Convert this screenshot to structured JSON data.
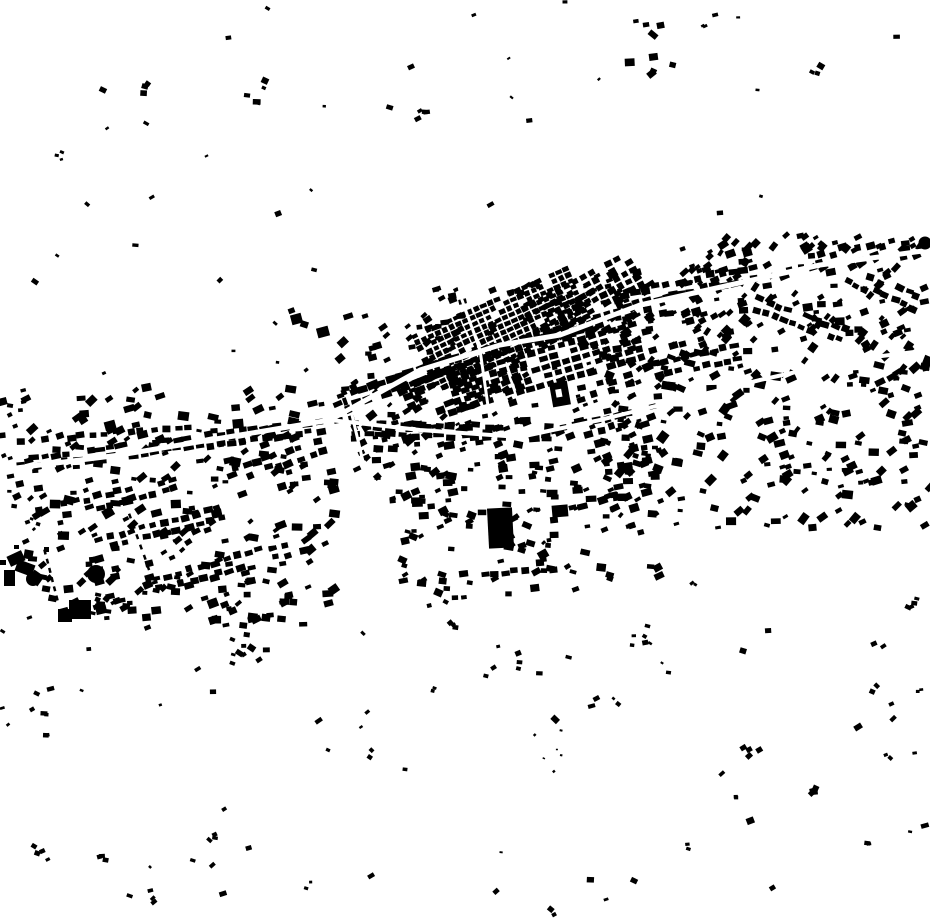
{
  "map": {
    "width": 930,
    "height": 924,
    "colors": {
      "ink": "#000000",
      "bg": "#ffffff"
    },
    "seed": 1337,
    "legend": {
      "scatter": "[x,y,w,h,count,sizeMin,sizeMax,angle,angleJitter]",
      "rows": "[x1,y1,x2,y2,[perpOffsets],spacing,bw,bh,posJitter,angJitter,skipProb]",
      "grids": "[cx,cy,w,h,angle,cellW,cellH,gapX,gapY,skipProb]",
      "clusters": "[cx,cy,radius,count,sizeMin,sizeMax]",
      "roads": "[strokeWidth,[x,y,x,y,...]]",
      "landmark_rects": "[x,y,w,h,angle]",
      "landmark_circles": "[cx,cy,r]",
      "landmark_holed": "[x,y,w,h,angle,holeX,holeY,holeW,holeH]",
      "landmark_dashes": "[x1,y1,x2,y2,count,dashW,dashL]"
    },
    "scatter": [
      [
        25,
        385,
        310,
        235,
        230,
        5,
        11,
        -15,
        30
      ],
      [
        335,
        315,
        130,
        165,
        75,
        5,
        10,
        -20,
        25
      ],
      [
        360,
        420,
        300,
        90,
        130,
        5,
        11,
        -8,
        20
      ],
      [
        400,
        510,
        260,
        90,
        70,
        5,
        10,
        -5,
        30
      ],
      [
        600,
        350,
        330,
        180,
        230,
        5,
        11,
        -15,
        40
      ],
      [
        680,
        235,
        250,
        115,
        150,
        5,
        10,
        -30,
        30
      ],
      [
        560,
        270,
        140,
        80,
        70,
        5,
        10,
        -25,
        20
      ],
      [
        430,
        280,
        210,
        150,
        110,
        4,
        9,
        -20,
        15
      ],
      [
        90,
        560,
        220,
        70,
        45,
        5,
        10,
        -12,
        20
      ],
      [
        0,
        0,
        930,
        225,
        26,
        3,
        7,
        0,
        45
      ],
      [
        0,
        630,
        930,
        290,
        52,
        3,
        8,
        0,
        45
      ],
      [
        0,
        235,
        330,
        140,
        10,
        3,
        7,
        0,
        45
      ],
      [
        0,
        390,
        30,
        140,
        18,
        4,
        9,
        -10,
        20
      ]
    ],
    "rows": [
      [
        30,
        462,
        330,
        425,
        [
          -4,
          5
        ],
        11,
        9,
        6,
        2,
        6,
        0.1
      ],
      [
        40,
        440,
        200,
        425,
        [
          0
        ],
        12,
        8,
        6,
        2,
        6,
        0.15
      ],
      [
        350,
        430,
        560,
        432,
        [
          -5,
          5
        ],
        12,
        9,
        6,
        2,
        6,
        0.2
      ],
      [
        350,
        398,
        460,
        360,
        [
          -5,
          6
        ],
        10,
        10,
        7,
        1.5,
        5,
        0.08
      ],
      [
        620,
        300,
        770,
        268,
        [
          -5,
          6
        ],
        11,
        9,
        6,
        2,
        6,
        0.12
      ],
      [
        770,
        268,
        920,
        243,
        [
          -4,
          6
        ],
        12,
        8,
        6,
        2,
        8,
        0.3
      ],
      [
        60,
        505,
        180,
        478,
        [
          0,
          10
        ],
        11,
        8,
        6,
        2,
        7,
        0.15
      ],
      [
        95,
        540,
        230,
        505,
        [
          0,
          11
        ],
        11,
        8,
        6,
        2,
        7,
        0.15
      ],
      [
        150,
        580,
        300,
        540,
        [
          0,
          11
        ],
        12,
        8,
        6,
        2,
        7,
        0.2
      ],
      [
        230,
        470,
        330,
        440,
        [
          0,
          10
        ],
        11,
        8,
        6,
        2,
        7,
        0.15
      ],
      [
        648,
        352,
        745,
        330,
        [
          0,
          13,
          26
        ],
        10,
        8,
        6,
        1.5,
        5,
        0.15
      ],
      [
        560,
        430,
        660,
        405,
        [
          0,
          10
        ],
        11,
        8,
        6,
        2,
        7,
        0.2
      ],
      [
        460,
        575,
        560,
        568,
        [
          0
        ],
        10,
        8,
        6,
        2,
        6,
        0.2
      ],
      [
        575,
        390,
        640,
        372,
        [
          0,
          10
        ],
        10,
        8,
        6,
        2,
        6,
        0.2
      ],
      [
        755,
        297,
        850,
        332,
        [
          0,
          11
        ],
        10,
        8,
        6,
        2,
        7,
        0.2
      ],
      [
        848,
        268,
        925,
        300,
        [
          0,
          12
        ],
        10,
        8,
        6,
        2,
        7,
        0.25
      ],
      [
        338,
        380,
        358,
        435,
        [
          0
        ],
        9,
        7,
        5,
        1.5,
        6,
        0.1
      ]
    ],
    "grids": [
      [
        505,
        330,
        170,
        62,
        -24,
        6,
        5,
        1.5,
        1.5,
        0.12
      ],
      [
        545,
        362,
        190,
        58,
        -16,
        8,
        6,
        2.5,
        2.5,
        0.22
      ],
      [
        470,
        390,
        120,
        50,
        -20,
        9,
        7,
        3,
        3,
        0.3
      ],
      [
        588,
        300,
        120,
        45,
        -28,
        7,
        6,
        2.5,
        2.5,
        0.25
      ]
    ],
    "clusters": [
      [
        648,
        52,
        42,
        9,
        5,
        10
      ],
      [
        425,
        112,
        16,
        4,
        4,
        8
      ],
      [
        258,
        100,
        26,
        5,
        4,
        8
      ],
      [
        146,
        87,
        12,
        3,
        4,
        7
      ],
      [
        66,
        152,
        14,
        3,
        3,
        6
      ],
      [
        812,
        72,
        10,
        3,
        4,
        7
      ],
      [
        703,
        26,
        6,
        2,
        3,
        5
      ],
      [
        294,
        322,
        22,
        2,
        6,
        8
      ],
      [
        240,
        648,
        26,
        8,
        4,
        8
      ],
      [
        448,
        616,
        20,
        5,
        4,
        7
      ],
      [
        500,
        660,
        26,
        5,
        3,
        6
      ],
      [
        640,
        640,
        22,
        6,
        4,
        7
      ],
      [
        752,
        752,
        12,
        4,
        4,
        7
      ],
      [
        815,
        790,
        14,
        4,
        4,
        7
      ],
      [
        911,
        607,
        12,
        4,
        4,
        7
      ],
      [
        877,
        650,
        8,
        2,
        4,
        6
      ],
      [
        880,
        690,
        8,
        2,
        4,
        6
      ],
      [
        40,
        708,
        10,
        3,
        4,
        7
      ],
      [
        50,
        735,
        8,
        2,
        4,
        6
      ],
      [
        208,
        835,
        8,
        3,
        4,
        6
      ],
      [
        100,
        858,
        8,
        2,
        4,
        6
      ],
      [
        44,
        858,
        10,
        3,
        4,
        7
      ],
      [
        150,
        895,
        12,
        3,
        4,
        6
      ],
      [
        305,
        885,
        8,
        2,
        3,
        5
      ],
      [
        550,
        908,
        8,
        2,
        4,
        6
      ],
      [
        868,
        848,
        8,
        2,
        4,
        6
      ],
      [
        686,
        845,
        8,
        2,
        3,
        5
      ],
      [
        740,
        798,
        6,
        2,
        3,
        5
      ],
      [
        890,
        758,
        6,
        2,
        3,
        5
      ],
      [
        922,
        690,
        6,
        2,
        3,
        5
      ],
      [
        35,
        523,
        10,
        4,
        3,
        5
      ],
      [
        110,
        600,
        18,
        5,
        4,
        7
      ],
      [
        368,
        755,
        6,
        2,
        3,
        5
      ],
      [
        430,
        690,
        6,
        2,
        3,
        5
      ],
      [
        615,
        700,
        6,
        2,
        3,
        5
      ],
      [
        692,
        583,
        6,
        2,
        3,
        5
      ],
      [
        544,
        545,
        8,
        3,
        4,
        6
      ],
      [
        560,
        750,
        40,
        6,
        2,
        3
      ]
    ],
    "roads": [
      [
        5,
        [
          0,
          470,
          120,
          455,
          240,
          435,
          330,
          420,
          420,
          370,
          500,
          345,
          560,
          335,
          640,
          305,
          730,
          285,
          820,
          265,
          930,
          250
        ]
      ],
      [
        4,
        [
          330,
          420,
          420,
          430,
          520,
          437,
          600,
          420,
          680,
          400,
          760,
          380,
          850,
          360,
          930,
          350
        ]
      ],
      [
        3,
        [
          490,
          420,
          480,
          350,
          462,
          300,
          452,
          255
        ]
      ],
      [
        3,
        [
          352,
          415,
          365,
          470,
          385,
          540,
          402,
          600
        ]
      ]
    ],
    "landmarks": {
      "rects": [
        [
          58,
          609,
          14,
          13,
          0
        ],
        [
          69,
          600,
          22,
          19,
          0
        ],
        [
          291,
          314,
          11,
          10,
          -15
        ],
        [
          317,
          327,
          12,
          10,
          -15
        ],
        [
          488,
          508,
          25,
          40,
          -3
        ],
        [
          552,
          505,
          16,
          12,
          -5
        ],
        [
          8,
          553,
          16,
          11,
          -25
        ],
        [
          16,
          562,
          18,
          12,
          20
        ],
        [
          4,
          570,
          11,
          16,
          0
        ],
        [
          24,
          550,
          9,
          9,
          10
        ],
        [
          30,
          572,
          12,
          12,
          35
        ],
        [
          44,
          547,
          5,
          5,
          0
        ],
        [
          14,
          545,
          5,
          4,
          0
        ],
        [
          0,
          560,
          6,
          5,
          0
        ]
      ],
      "circles": [
        [
          925,
          243,
          6.5
        ],
        [
          33,
          579,
          7
        ],
        [
          96,
          574,
          9
        ]
      ],
      "holed": [
        [
          551,
          382,
          18,
          24,
          -10,
          556,
          389,
          6,
          8
        ]
      ],
      "dashes": [
        [
          130,
          516,
          152,
          578,
          7,
          2.5,
          5
        ],
        [
          45,
          552,
          57,
          598,
          6,
          2.5,
          5
        ]
      ]
    }
  }
}
